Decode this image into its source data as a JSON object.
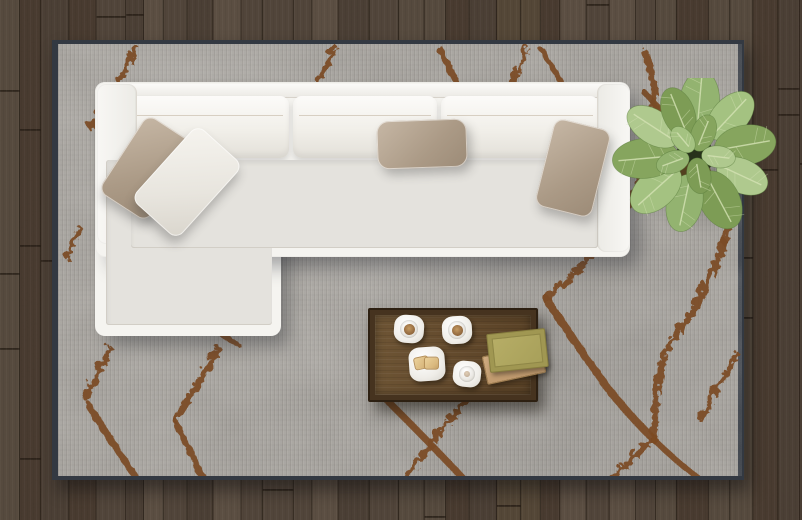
{
  "scene": {
    "description": "Top view of a modern living room: white L-shaped sectional sofa on a gray rug with rust diamond pattern, wooden coffee table with coffee cups and books, potted plant, dark hardwood plank floor",
    "floor": {
      "label": "dark wood plank floor",
      "base_color": "#4e4238",
      "plank_colors": [
        "#51453a",
        "#4b3f35",
        "#564a3e",
        "#483a2f",
        "#544737",
        "#5c4f43"
      ],
      "seam_color": "#241c14"
    },
    "rug": {
      "label": "gray area rug with rust diamond lattice pattern",
      "base_color": "#a3a09b",
      "border_color": "#333942",
      "pattern_color": "#7b4b25"
    },
    "sofa": {
      "label": "white L-shaped sectional sofa with chaise",
      "fabric_color": "#f5f4f0",
      "deck_color": "#e4e2dd",
      "piping_color": "#cfc6b6",
      "back_cushion_count": 3,
      "pillows": [
        {
          "label": "taupe pillow on chaise",
          "color": "#ab9a86"
        },
        {
          "label": "white pillow on chaise",
          "color": "#ece9e2"
        },
        {
          "label": "taupe pillow center back",
          "color": "#b0a08c"
        },
        {
          "label": "taupe pillow right arm",
          "color": "#b2a28e"
        }
      ]
    },
    "plant": {
      "label": "green potted plant, top view",
      "leaf_colors": [
        "#93b370",
        "#a4c281",
        "#86a55e",
        "#afc98e",
        "#7d9c55"
      ],
      "vein_color": "#d4e2b4",
      "soil_color": "#53401f",
      "center_color": "#27311b"
    },
    "coffee_table": {
      "label": "rectangular wooden coffee table",
      "frame_color": "#2d2012",
      "top_color": "#62492c",
      "items": [
        {
          "label": "coffee cup with saucer",
          "contents_color": "#9a7044"
        },
        {
          "label": "coffee cup with saucer",
          "contents_color": "#9a7044"
        },
        {
          "label": "plate with two biscuits",
          "biscuit_color": "#d9b87e"
        },
        {
          "label": "small white cup with saucer",
          "contents_color": "#e4e1da"
        },
        {
          "label": "olive green book",
          "color": "#a8a05a"
        },
        {
          "label": "tan book",
          "color": "#c09a6e"
        }
      ]
    }
  }
}
